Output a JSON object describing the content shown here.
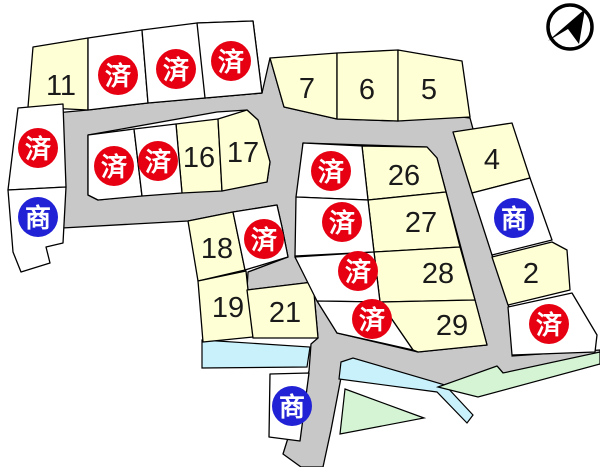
{
  "map": {
    "width": 600,
    "height": 467,
    "colors": {
      "background": "#ffffff",
      "road": "#c8c8c8",
      "lot_available": "#ffffd6",
      "lot_taken": "#ffffff",
      "water": "#c9f1fb",
      "green": "#d4f4d4",
      "sold_badge": "#e60012",
      "commercial_badge": "#2121d6",
      "badge_text": "#ffffff",
      "number_text": "#1a1a1a",
      "outline": "#000000"
    },
    "badges": {
      "sold_label": "済",
      "commercial_label": "商"
    },
    "road_path": "M55,113 L88,110 L148,103 L205,98 L262,93 L270,58 L284,107 L337,119 L398,121 L452,116 L470,118 L473,129 L477,193 L492,255 L507,300 L517,338 L512,356 L600,350 L600,364 L504,374 L498,367 L438,387 L352,359 L344,362 L331,430 L323,467 L301,467 L283,454 L309,371 L311,344 L318,338 L313,282 L247,290 L248,272 L288,257 L282,227 L277,205 L233,212 L188,221 L62,228 Z M88,135 L217,112 L247,110 L258,120 L270,162 L267,182 L98,200 L88,195 Z M303,143 L427,147 L437,158 L487,345 L418,352 L337,333 L295,257 Z",
    "water_polygons": [
      "202,340 310,347 307,367 202,368",
      "341,362 353,358 445,385 473,415 467,423 437,392 339,379"
    ],
    "green_polygons": [
      "345,389 424,418 340,434",
      "438,387 497,366 503,373 600,352 600,364 478,397"
    ],
    "lots": [
      {
        "number": "11",
        "status": "available",
        "polygon": "33,47 88,38 88,110 28,107",
        "lx": 61,
        "ly": 86
      },
      {
        "number": "7",
        "status": "available",
        "polygon": "270,58 337,53 337,119 284,107",
        "lx": 307,
        "ly": 89
      },
      {
        "number": "6",
        "status": "available",
        "polygon": "337,53 398,50 398,121 337,119",
        "lx": 367,
        "ly": 90
      },
      {
        "number": "5",
        "status": "available",
        "polygon": "398,50 462,61 470,117 398,121",
        "lx": 429,
        "ly": 90
      },
      {
        "number": "16",
        "status": "available",
        "polygon": "176,124 218,119 222,191 182,193",
        "lx": 199,
        "ly": 158
      },
      {
        "number": "17",
        "status": "available",
        "polygon": "218,119 247,110 258,120 270,162 267,182 222,191",
        "lx": 243,
        "ly": 153
      },
      {
        "number": "4",
        "status": "available",
        "polygon": "453,132 512,123 530,178 472,193",
        "lx": 492,
        "ly": 160
      },
      {
        "number": "2",
        "status": "available",
        "polygon": "492,257 552,242 567,250 570,290 508,305",
        "lx": 531,
        "ly": 274
      },
      {
        "number": "18",
        "status": "available",
        "polygon": "188,221 233,212 245,270 198,281",
        "lx": 217,
        "ly": 249
      },
      {
        "number": "19",
        "status": "available",
        "polygon": "198,281 246,271 253,337 203,342",
        "lx": 228,
        "ly": 308
      },
      {
        "number": "21",
        "status": "available",
        "polygon": "247,290 313,282 318,338 253,338",
        "lx": 285,
        "ly": 313
      },
      {
        "number": "26",
        "status": "available",
        "polygon": "362,146 427,147 437,158 446,192 368,200",
        "lx": 404,
        "ly": 176
      },
      {
        "number": "27",
        "status": "available",
        "polygon": "368,200 446,192 460,247 374,252",
        "lx": 421,
        "ly": 223
      },
      {
        "number": "28",
        "status": "available",
        "polygon": "374,252 460,247 475,300 380,302",
        "lx": 438,
        "ly": 274
      },
      {
        "number": "29",
        "status": "available",
        "polygon": "380,302 475,300 487,345 418,352 413,350",
        "lx": 452,
        "ly": 326
      },
      {
        "number": "",
        "status": "sold",
        "polygon": "88,38 142,30 148,103 88,110",
        "lx": 118,
        "ly": 75
      },
      {
        "number": "",
        "status": "sold",
        "polygon": "142,30 197,23 253,21 262,93 205,98 148,103",
        "lx": 176,
        "ly": 69
      },
      {
        "number": "",
        "status": "sold",
        "polygon": "197,23 253,21 262,93 205,98",
        "lx": 231,
        "ly": 61
      },
      {
        "number": "",
        "status": "sold",
        "polygon": "18,108 63,104 66,187 8,190",
        "lx": 38,
        "ly": 148
      },
      {
        "number": "",
        "status": "sold",
        "polygon": "88,135 134,129 142,196 98,200 88,195",
        "lx": 114,
        "ly": 166
      },
      {
        "number": "",
        "status": "sold",
        "polygon": "134,129 176,124 182,193 142,196",
        "lx": 158,
        "ly": 161
      },
      {
        "number": "",
        "status": "sold",
        "polygon": "233,212 277,205 282,227 288,257 245,270",
        "lx": 264,
        "ly": 239
      },
      {
        "number": "",
        "status": "sold",
        "polygon": "303,143 362,146 368,200 296,197",
        "lx": 331,
        "ly": 171
      },
      {
        "number": "",
        "status": "sold",
        "polygon": "296,197 368,200 374,252 295,256",
        "lx": 342,
        "ly": 222
      },
      {
        "number": "",
        "status": "sold",
        "polygon": "295,257 374,252 380,302 317,301",
        "lx": 358,
        "ly": 271
      },
      {
        "number": "",
        "status": "sold",
        "polygon": "317,301 380,302 413,350 337,333",
        "lx": 372,
        "ly": 319
      },
      {
        "number": "",
        "status": "sold",
        "polygon": "508,307 572,293 597,335 595,352 512,355",
        "lx": 549,
        "ly": 324
      },
      {
        "number": "",
        "status": "commercial",
        "polygon": "8,190 66,187 63,243 46,247 50,263 21,272 13,252",
        "lx": 38,
        "ly": 217
      },
      {
        "number": "",
        "status": "commercial",
        "polygon": "472,193 530,178 552,240 492,255",
        "lx": 514,
        "ly": 218
      },
      {
        "number": "",
        "status": "commercial",
        "polygon": "270,374 309,373 300,441 269,437",
        "lx": 292,
        "ly": 406
      }
    ],
    "compass": {
      "cx": 570,
      "cy": 27,
      "r": 22,
      "arrow": "585,9 579,44 568,29 548,41"
    }
  }
}
